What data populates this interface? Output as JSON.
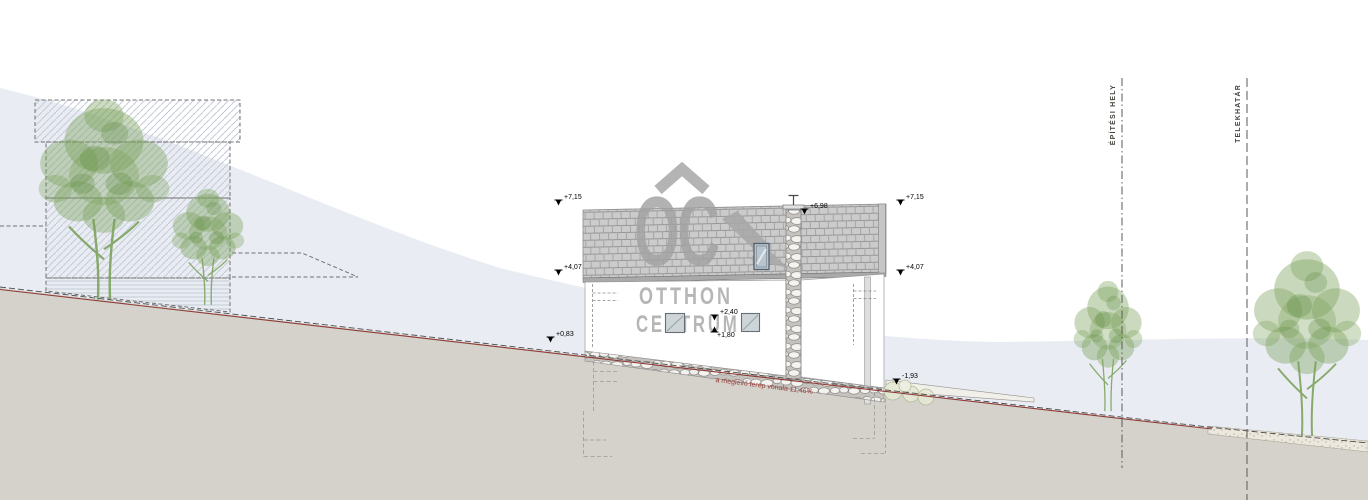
{
  "watermark": {
    "monogram": "OC",
    "line1": "OTTHON",
    "line2": "CENTRUM"
  },
  "levels": {
    "ridge_left": "+7,15",
    "eaves_left": "+4,07",
    "ground_left": "+0,83",
    "ridge_right": "+7,15",
    "eaves_right": "+4,07",
    "chimney_top": "+6,98",
    "floor_upper": "+2,40",
    "floor_lower": "+1,80",
    "terrace": "-1,93"
  },
  "boundaries": {
    "building_site": "ÉPÍTÉSI HELY",
    "plot_line": "TELEKHATÁR"
  },
  "terrain": {
    "existing_line_note": "a meglévő terep vonala 11,46%"
  },
  "colors": {
    "hill": "#e9edf3",
    "ground": "#d5d1cb",
    "tree_green": "#7ca25c",
    "terrain_line_red": "#8e3b36",
    "watermark_gray": "#a5a5a5"
  }
}
